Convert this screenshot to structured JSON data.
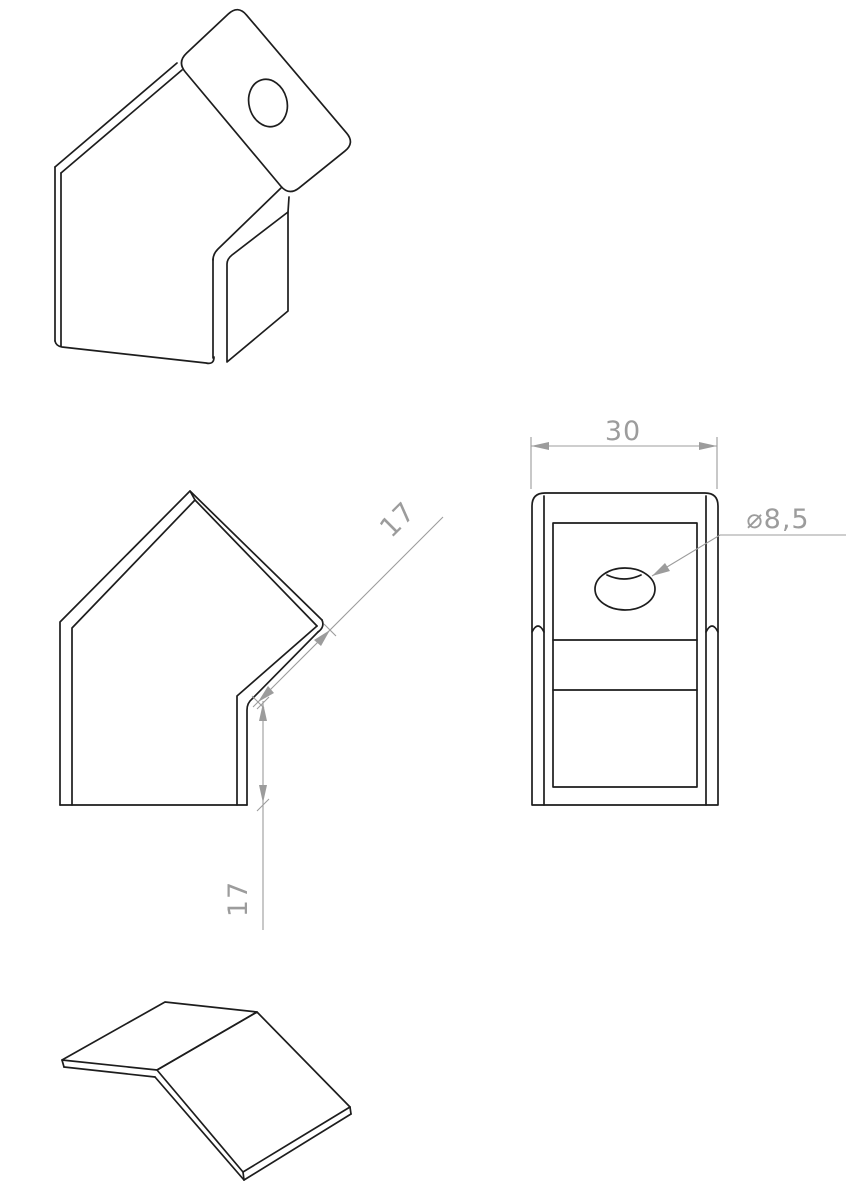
{
  "drawing": {
    "dimensions": {
      "overall_width": "30",
      "hole_diameter": "⌀8,5",
      "flange_length": "17",
      "leg_height": "17"
    },
    "colors": {
      "background": "#ffffff",
      "part_line": "#1d1d1d",
      "dimension": "#9c9c9c"
    }
  }
}
